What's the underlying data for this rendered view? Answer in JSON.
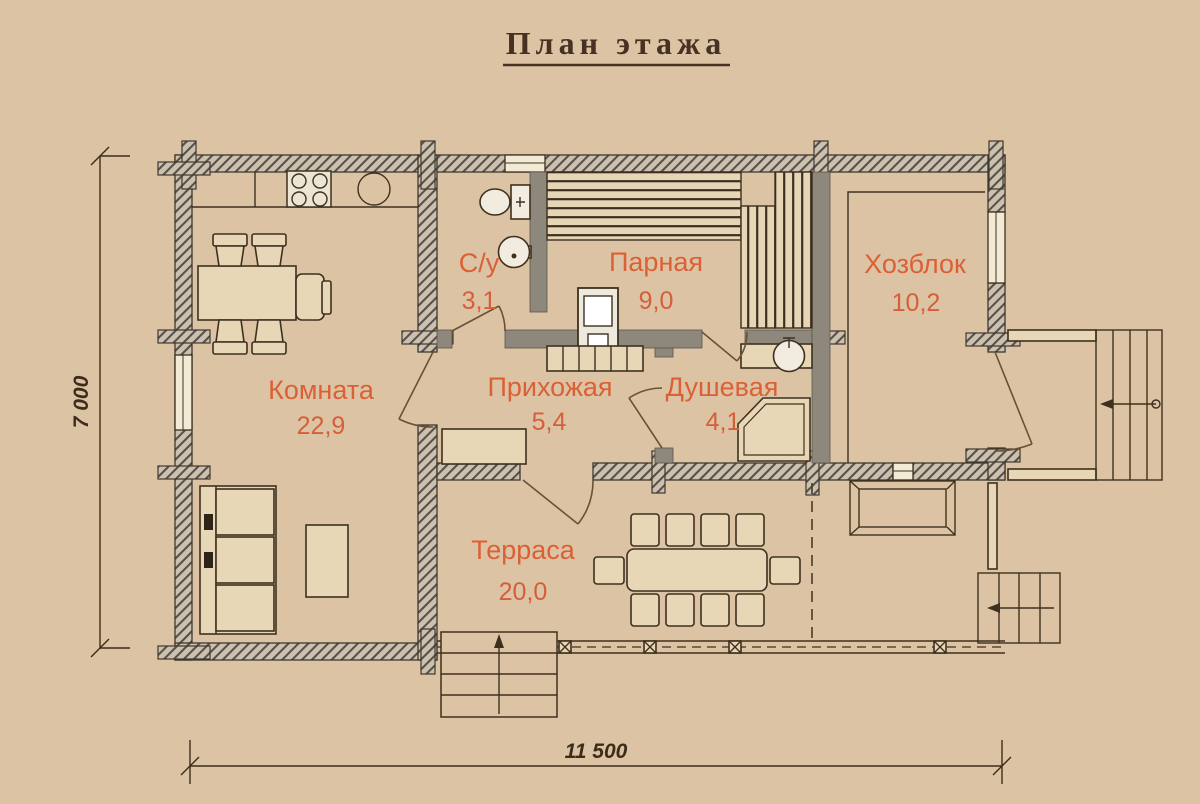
{
  "title": "План этажа",
  "rooms": [
    {
      "name": "С/у",
      "area": "3,1"
    },
    {
      "name": "Парная",
      "area": "9,0"
    },
    {
      "name": "Хозблок",
      "area": "10,2"
    },
    {
      "name": "Комната",
      "area": "22,9"
    },
    {
      "name": "Прихожая",
      "area": "5,4"
    },
    {
      "name": "Душевая",
      "area": "4,1"
    },
    {
      "name": "Терраса",
      "area": "20,0"
    }
  ],
  "dimensions": {
    "overall_width_mm": "11 500",
    "overall_depth_mm": "7 000"
  },
  "drawing": {
    "type": "floor-plan",
    "colors": {
      "background": "#dcc3a3",
      "room_label": "#db6036",
      "exterior_wall_hatch": "#ccc0ae",
      "interior_wall": "#8e887c",
      "line": "#3e301e",
      "title": "#463122"
    },
    "icons": [
      "stove-icon",
      "kitchen-sink-icon",
      "toilet-icon",
      "washbasin-icon",
      "shower-cabin-icon",
      "sauna-bench-icon",
      "sauna-heater-icon",
      "sofa-icon",
      "dining-table-icon",
      "terrace-table-icon",
      "stairs-icon",
      "arrow-icon"
    ]
  }
}
